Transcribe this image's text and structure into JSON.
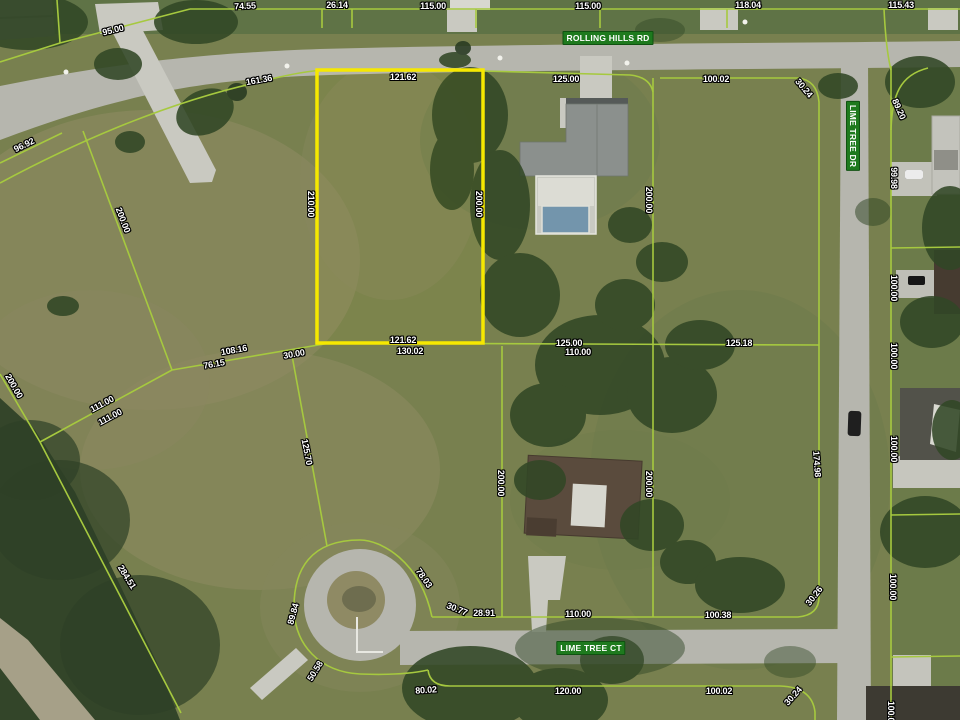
{
  "map": {
    "type": "satellite-parcel-view",
    "roads": [
      {
        "name": "ROLLING HILLS RD",
        "orientation": "horizontal"
      },
      {
        "name": "LIME TREE DR",
        "orientation": "vertical"
      },
      {
        "name": "LIME TREE CT",
        "orientation": "horizontal"
      }
    ],
    "highlighted_lot": {
      "frontage": "121.62",
      "depth_west": "210.00",
      "depth_east": "200.00",
      "rear": "121.62",
      "outline_color": "#f6e800"
    },
    "colors": {
      "parcel_line": "#a6c93f",
      "highlight": "#f6e800",
      "road_badge_green": "#1e7a1e",
      "label_text": "#ffffff",
      "label_outline": "#000000",
      "road_gray": "#b6b6ae",
      "grass_olive": "#78804f"
    },
    "road_badges": [
      {
        "t": "ROLLING HILLS RD",
        "x": 608,
        "y": 38,
        "r": 0
      },
      {
        "t": "LIME TREE DR",
        "x": 853,
        "y": 136,
        "r": 90
      },
      {
        "t": "LIME TREE CT",
        "x": 591,
        "y": 648,
        "r": 0
      }
    ],
    "dimension_labels": [
      {
        "t": "74.55",
        "x": 245,
        "y": 6,
        "r": -3
      },
      {
        "t": "26.14",
        "x": 337,
        "y": 5,
        "r": 0
      },
      {
        "t": "115.00",
        "x": 433,
        "y": 6,
        "r": 0
      },
      {
        "t": "115.00",
        "x": 588,
        "y": 6,
        "r": 0
      },
      {
        "t": "118.04",
        "x": 748,
        "y": 5,
        "r": 0
      },
      {
        "t": "115.43",
        "x": 901,
        "y": 5,
        "r": 0
      },
      {
        "t": "95.00",
        "x": 113,
        "y": 30,
        "r": -14
      },
      {
        "t": "161.36",
        "x": 259,
        "y": 80,
        "r": -10
      },
      {
        "t": "121.62",
        "x": 403,
        "y": 77,
        "r": 0
      },
      {
        "t": "125.00",
        "x": 566,
        "y": 79,
        "r": 0
      },
      {
        "t": "100.02",
        "x": 716,
        "y": 79,
        "r": 0
      },
      {
        "t": "30.24",
        "x": 804,
        "y": 88,
        "r": 50
      },
      {
        "t": "89.20",
        "x": 899,
        "y": 109,
        "r": 66
      },
      {
        "t": "96.92",
        "x": 24,
        "y": 145,
        "r": -26
      },
      {
        "t": "200.00",
        "x": 123,
        "y": 220,
        "r": 69
      },
      {
        "t": "200.00",
        "x": 14,
        "y": 386,
        "r": 60
      },
      {
        "t": "111.00",
        "x": 102,
        "y": 404,
        "r": -28
      },
      {
        "t": "111.00",
        "x": 110,
        "y": 417,
        "r": -28
      },
      {
        "t": "210.00",
        "x": 311,
        "y": 204,
        "r": 90
      },
      {
        "t": "200.00",
        "x": 479,
        "y": 204,
        "r": 90
      },
      {
        "t": "200.00",
        "x": 649,
        "y": 200,
        "r": 90
      },
      {
        "t": "108.16",
        "x": 234,
        "y": 350,
        "r": -10
      },
      {
        "t": "76.15",
        "x": 214,
        "y": 364,
        "r": -10
      },
      {
        "t": "30.00",
        "x": 294,
        "y": 354,
        "r": -10
      },
      {
        "t": "121.62",
        "x": 403,
        "y": 340,
        "r": 0
      },
      {
        "t": "130.02",
        "x": 410,
        "y": 351,
        "r": 0
      },
      {
        "t": "125.00",
        "x": 569,
        "y": 343,
        "r": 0
      },
      {
        "t": "110.00",
        "x": 578,
        "y": 352,
        "r": 0
      },
      {
        "t": "125.18",
        "x": 739,
        "y": 343,
        "r": 0
      },
      {
        "t": "99.98",
        "x": 894,
        "y": 178,
        "r": 90
      },
      {
        "t": "100.00",
        "x": 894,
        "y": 288,
        "r": 90
      },
      {
        "t": "100.00",
        "x": 894,
        "y": 356,
        "r": 90
      },
      {
        "t": "174.98",
        "x": 817,
        "y": 464,
        "r": 86
      },
      {
        "t": "100.00",
        "x": 894,
        "y": 449,
        "r": 90
      },
      {
        "t": "200.00",
        "x": 501,
        "y": 483,
        "r": 90
      },
      {
        "t": "200.00",
        "x": 649,
        "y": 484,
        "r": 90
      },
      {
        "t": "125.70",
        "x": 307,
        "y": 452,
        "r": 79
      },
      {
        "t": "284.51",
        "x": 127,
        "y": 577,
        "r": 58
      },
      {
        "t": "78.03",
        "x": 424,
        "y": 578,
        "r": 55
      },
      {
        "t": "30.77",
        "x": 457,
        "y": 609,
        "r": 22
      },
      {
        "t": "28.91",
        "x": 484,
        "y": 613,
        "r": 0
      },
      {
        "t": "110.00",
        "x": 578,
        "y": 614,
        "r": 0
      },
      {
        "t": "89.84",
        "x": 293,
        "y": 614,
        "r": -75
      },
      {
        "t": "50.58",
        "x": 315,
        "y": 671,
        "r": -58
      },
      {
        "t": "80.02",
        "x": 426,
        "y": 690,
        "r": -4
      },
      {
        "t": "120.00",
        "x": 568,
        "y": 691,
        "r": 0
      },
      {
        "t": "100.38",
        "x": 718,
        "y": 615,
        "r": 0
      },
      {
        "t": "30.26",
        "x": 814,
        "y": 596,
        "r": -52
      },
      {
        "t": "100.02",
        "x": 719,
        "y": 691,
        "r": 0
      },
      {
        "t": "30.24",
        "x": 793,
        "y": 696,
        "r": -48
      },
      {
        "t": "100.00",
        "x": 893,
        "y": 587,
        "r": 90
      },
      {
        "t": "100.00",
        "x": 891,
        "y": 714,
        "r": 90
      }
    ]
  }
}
